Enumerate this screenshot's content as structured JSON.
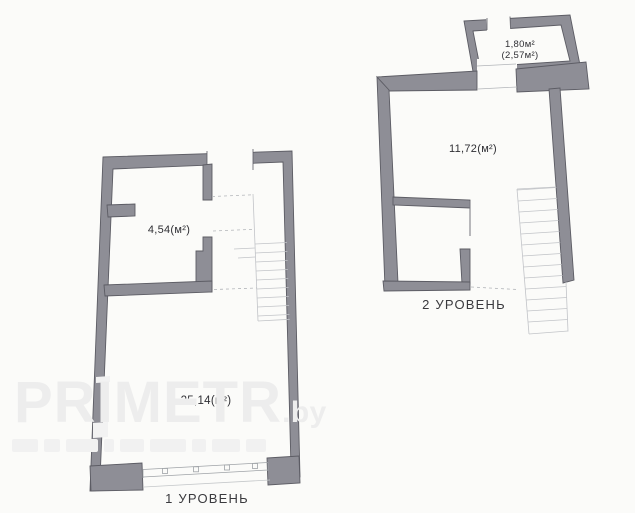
{
  "colors": {
    "wall_fill": "#8e8e96",
    "wall_outline": "#5c5c64",
    "stair_line": "#c2c4c8",
    "dashed_line": "#b2b5b9",
    "window_line": "#9fa3a7",
    "label_text": "#2f2f34",
    "caption_text": "#3a3a3e",
    "watermark": "#ededed",
    "background": "#fbfbf9"
  },
  "level1": {
    "caption": "1 УРОВЕНЬ",
    "room_small_area": "4,54(м²)",
    "room_main_area": "25,14(м²)"
  },
  "level2": {
    "caption": "2 УРОВЕНЬ",
    "room_top_area_line1": "1,80м²",
    "room_top_area_line2": "(2,57м²)",
    "room_main_area": "11,72(м²)"
  },
  "watermark": {
    "brand": "PRIMETR",
    "suffix": ".by"
  }
}
